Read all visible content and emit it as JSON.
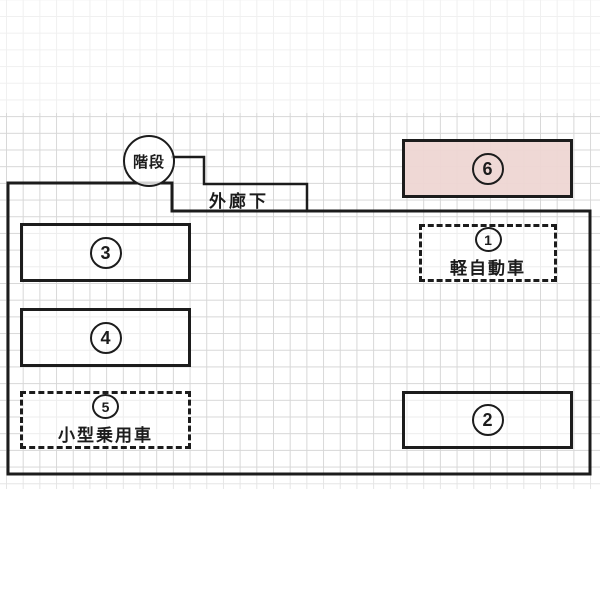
{
  "diagram": {
    "stairs_label": "階段",
    "corridor_label": "外廊下",
    "spaces": [
      {
        "number": "1",
        "label": "軽自動車",
        "border": "dashed"
      },
      {
        "number": "2",
        "label": "",
        "border": "solid"
      },
      {
        "number": "3",
        "label": "",
        "border": "solid"
      },
      {
        "number": "4",
        "label": "",
        "border": "solid"
      },
      {
        "number": "5",
        "label": "小型乗用車",
        "border": "dashed"
      },
      {
        "number": "6",
        "label": "",
        "border": "solid"
      }
    ],
    "colors": {
      "line": "#1c1c1c",
      "grid": "#d7d7d7",
      "space6_fill": "#eed6d2",
      "background": "#ffffff"
    }
  }
}
